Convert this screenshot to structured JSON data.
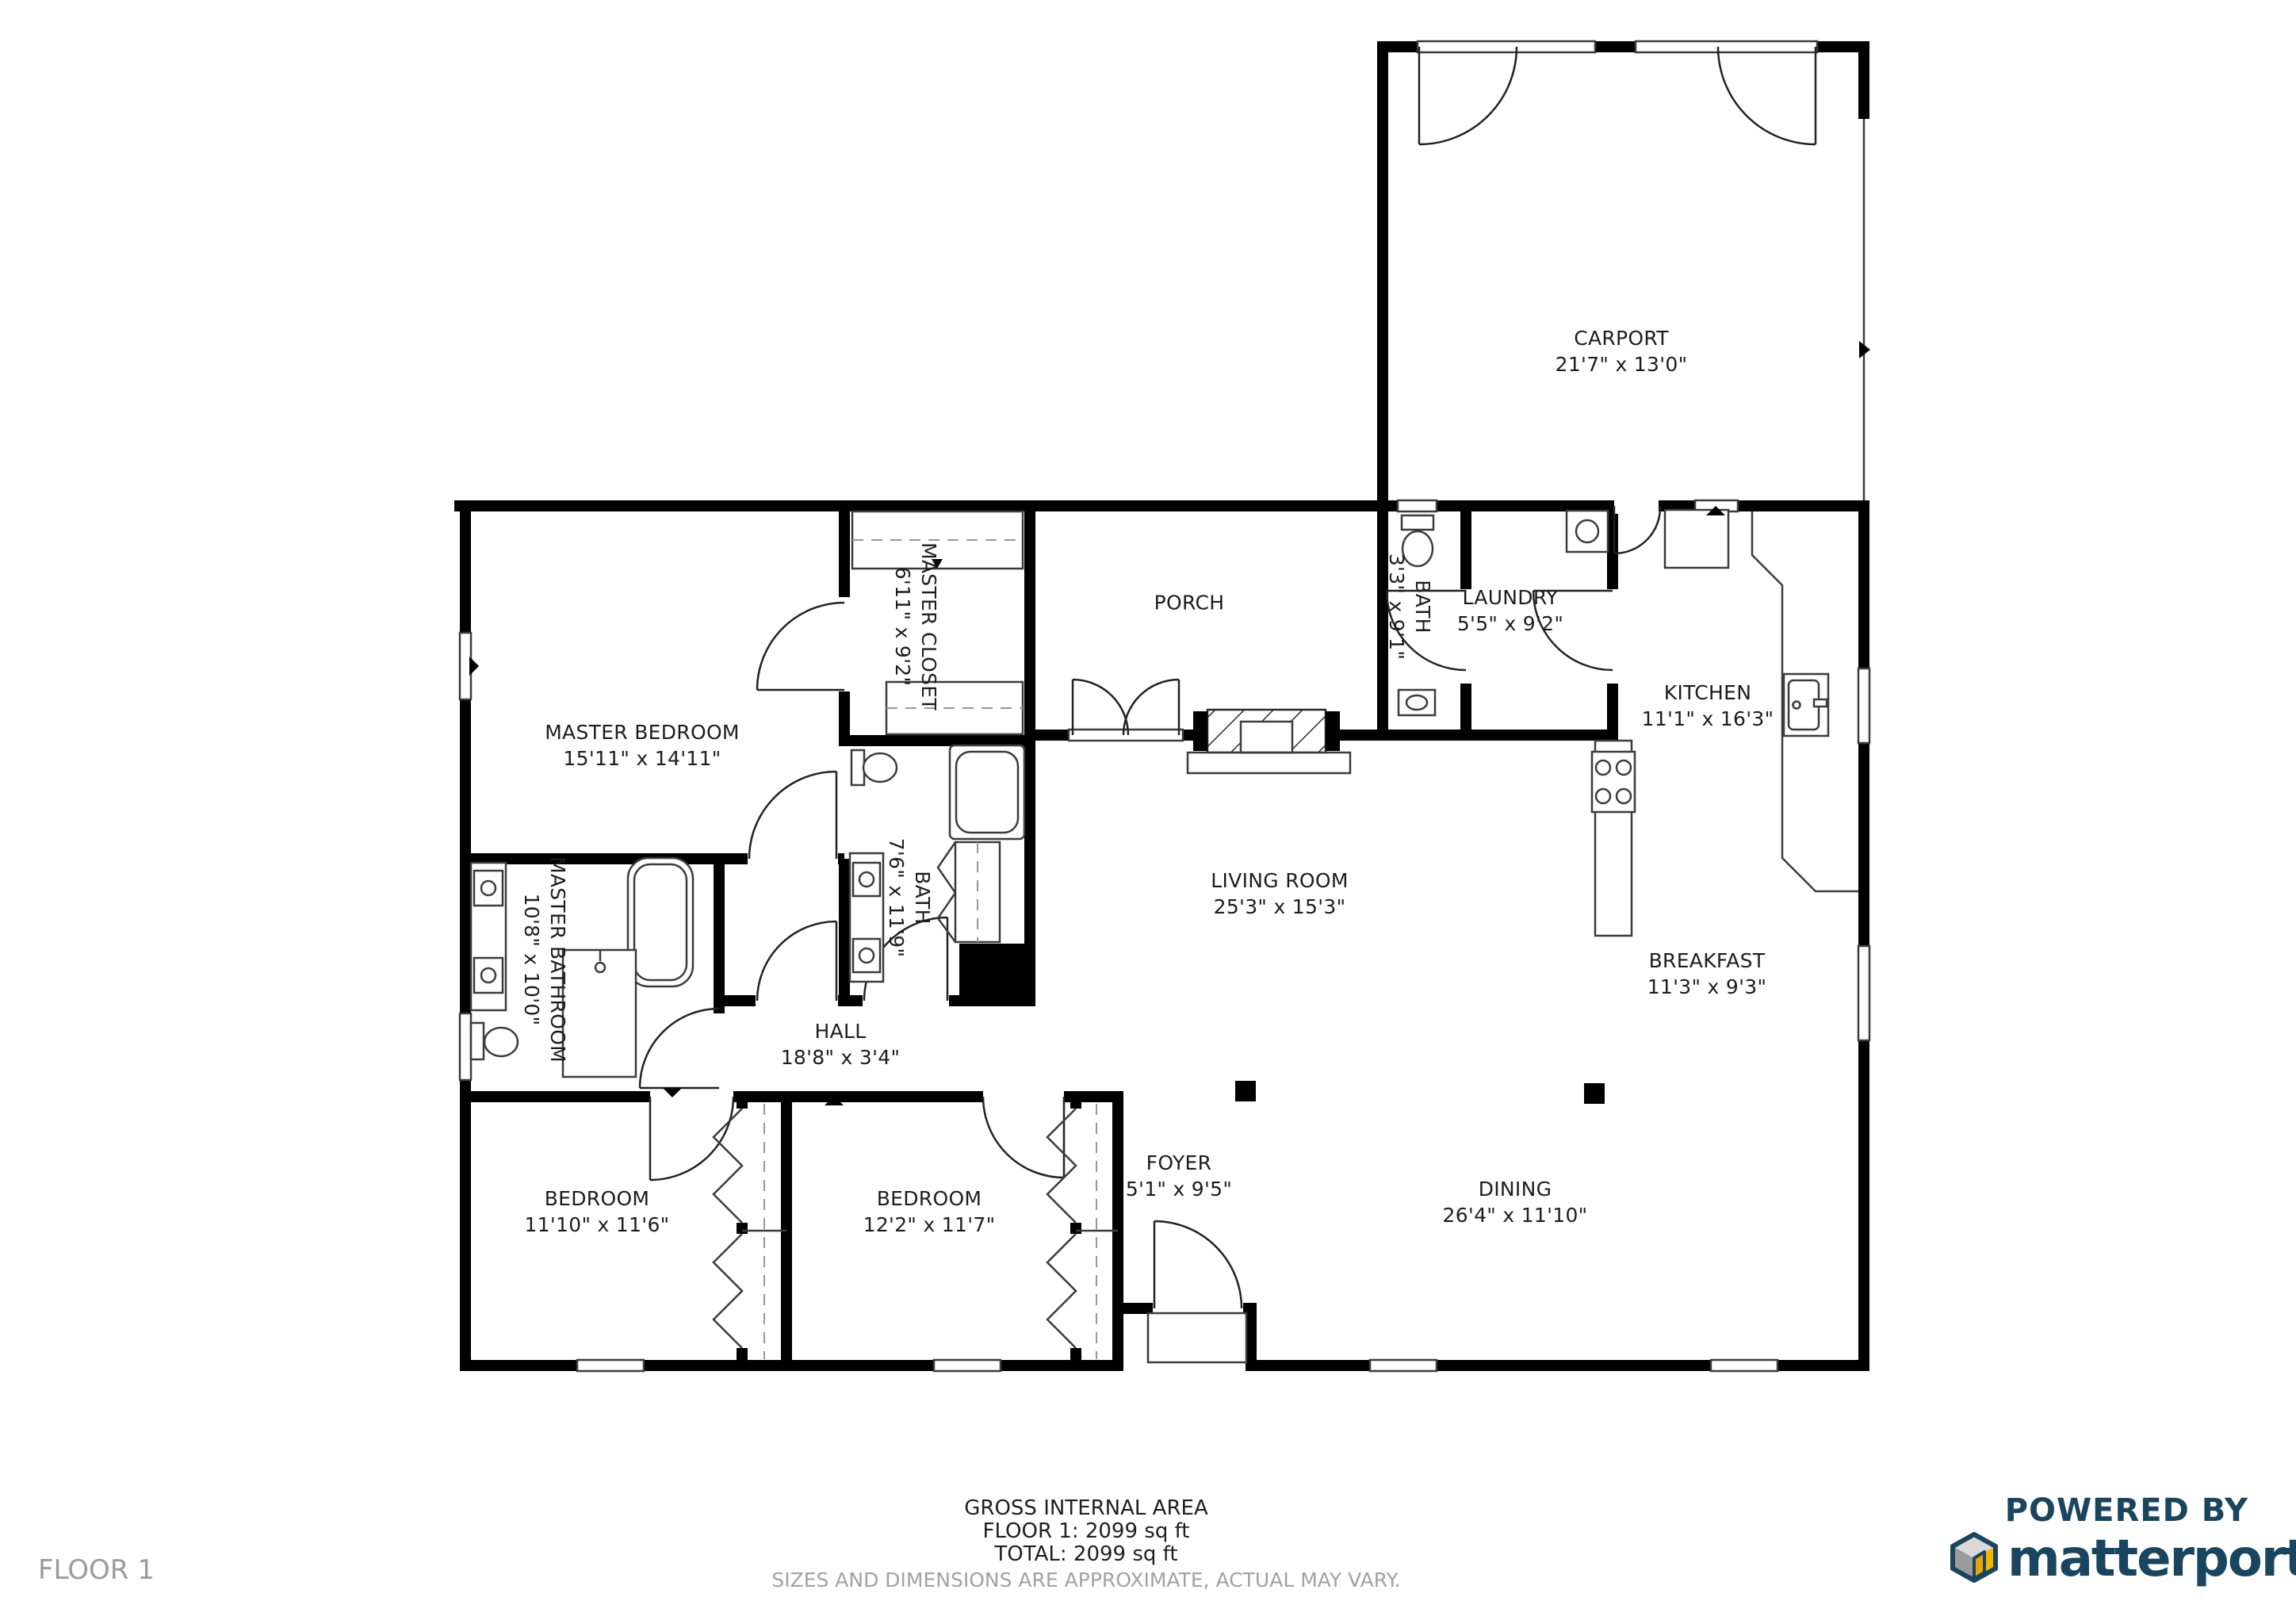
{
  "floor": {
    "label": "FLOOR 1"
  },
  "rooms": {
    "carport": {
      "name": "CARPORT",
      "dims": "21'7\" x 13'0\""
    },
    "master_bedroom": {
      "name": "MASTER BEDROOM",
      "dims": "15'11\" x 14'11\""
    },
    "master_closet": {
      "name": "MASTER CLOSET",
      "dims": "6'11\" x 9'2\""
    },
    "porch": {
      "name": "PORCH"
    },
    "bath_small": {
      "name": "BATH",
      "dims": "3'3\" x 9'1\""
    },
    "laundry": {
      "name": "LAUNDRY",
      "dims": "5'5\" x 9'2\""
    },
    "kitchen": {
      "name": "KITCHEN",
      "dims": "11'1\" x 16'3\""
    },
    "living_room": {
      "name": "LIVING ROOM",
      "dims": "25'3\" x 15'3\""
    },
    "master_bathroom": {
      "name": "MASTER BATHROOM",
      "dims": "10'8\" x 10'0\""
    },
    "bath": {
      "name": "BATH",
      "dims": "7'6\" x 11'9\""
    },
    "hall": {
      "name": "HALL",
      "dims": "18'8\" x 3'4\""
    },
    "breakfast": {
      "name": "BREAKFAST",
      "dims": "11'3\" x 9'3\""
    },
    "bedroom_left": {
      "name": "BEDROOM",
      "dims": "11'10\" x 11'6\""
    },
    "bedroom_mid": {
      "name": "BEDROOM",
      "dims": "12'2\" x 11'7\""
    },
    "foyer": {
      "name": "FOYER",
      "dims": "5'1\" x 9'5\""
    },
    "dining": {
      "name": "DINING",
      "dims": "26'4\" x 11'10\""
    }
  },
  "footer": {
    "gross_area_title": "GROSS INTERNAL AREA",
    "floor_area": "FLOOR 1: 2099 sq ft",
    "total_area": "TOTAL: 2099 sq ft",
    "disclaimer": "SIZES AND DIMENSIONS ARE APPROXIMATE, ACTUAL MAY VARY."
  },
  "branding": {
    "powered_by": "POWERED BY",
    "brand_name": "matterport",
    "registered_mark": "®",
    "brand_navy": "#19455e",
    "brand_yellow": "#f7b500",
    "brand_gray": "#9b9b9b"
  }
}
